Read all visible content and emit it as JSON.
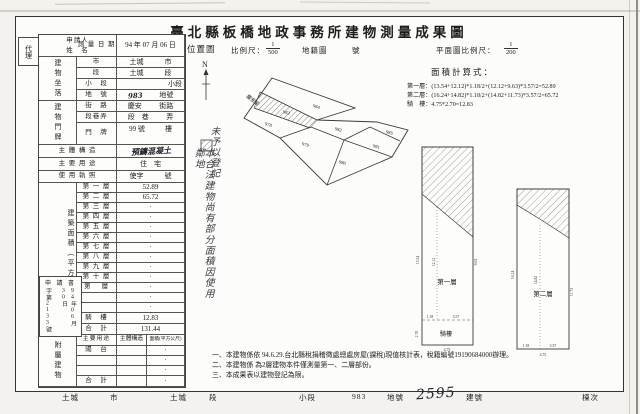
{
  "title": "臺北縣板橋地政事務所建物測量成果圖",
  "agent": "代理",
  "left_table": {
    "applicant_label_1": "申請人",
    "applicant_label_2": "姓　名",
    "survey_date_label": "測 量 日 期",
    "survey_date_value": "94 年 07 月 06 日",
    "site_group_label": "建物坐落",
    "site_rows": [
      {
        "label": "市",
        "value": "土城",
        "suffix": "市"
      },
      {
        "label": "段",
        "value": "土城",
        "suffix": "段"
      },
      {
        "label": "小　段",
        "value": "",
        "suffix": "小段"
      },
      {
        "label": "地　號",
        "value": "983",
        "suffix": "地號"
      }
    ],
    "door_group_label": "建物門牌",
    "street_label": "街　路",
    "street_value": "慶安",
    "street_suffix": "街路",
    "lane_label": "段巷弄",
    "lane_value": "段　巷",
    "lane_suffix": "弄",
    "door_no_label": "門　牌",
    "door_no_value": "99 號",
    "door_no_suffix": "樓",
    "structure_label": "主 體 構 造",
    "structure_value": "預鑄混凝土",
    "usage_label": "主 要 用 途",
    "usage_value": "住　宅",
    "license_label": "使 用 執 照",
    "license_prefix": "使字",
    "license_suffix": "號",
    "area_group_label": "建築面積（平方公尺）",
    "floors": [
      {
        "label": "第 一 層",
        "value": "52.89"
      },
      {
        "label": "第 二 層",
        "value": "65.72"
      },
      {
        "label": "第 三 層",
        "value": "·"
      },
      {
        "label": "第 四 層",
        "value": "·"
      },
      {
        "label": "第 五 層",
        "value": "·"
      },
      {
        "label": "第 六 層",
        "value": "·"
      },
      {
        "label": "第 七 層",
        "value": "·"
      },
      {
        "label": "第 八 層",
        "value": "·"
      },
      {
        "label": "第 九 層",
        "value": "·"
      },
      {
        "label": "第 十 層",
        "value": "·"
      },
      {
        "label": "第　 層",
        "value": "·"
      },
      {
        "label": "",
        "value": "·"
      },
      {
        "label": "",
        "value": "·"
      }
    ],
    "arcade_label": "騎　樓",
    "arcade_value": "12.83",
    "total_label": "合　計",
    "total_value": "131.44",
    "application": {
      "title": "申 請 書",
      "number_column": "字第2133號",
      "date_column": "94年06月30日"
    },
    "annex_group_label": "附屬建物",
    "annex_headers": [
      "主要用途",
      "主體構造",
      "面積(平方公尺)"
    ],
    "annex_rows": [
      {
        "use": "陽　台",
        "structure": "",
        "area": "·"
      },
      {
        "use": "",
        "structure": "",
        "area": "·"
      },
      {
        "use": "",
        "structure": "",
        "area": "·"
      },
      {
        "use": "合　計",
        "structure": "",
        "area": "·"
      }
    ]
  },
  "map_header": {
    "location_map_label": "位置圖",
    "scale_label": "比例尺：",
    "scale_numerator": "1",
    "scale_denominator": "500",
    "cadastral_label": "地籍圖",
    "cadastral_number_label": "號",
    "plan_scale_label": "平面圖比例尺：",
    "plan_scale_numerator": "1",
    "plan_scale_denominator": "200"
  },
  "location_map": {
    "north_label": "N",
    "street_label": "慶安街",
    "parcels": [
      "984",
      "983",
      "978",
      "982",
      "985",
      "979",
      "981",
      "980"
    ],
    "hand_note_col_1": "本合法建物尚有部分面積因使用鄰地",
    "hand_note_col_2": "未予以登記"
  },
  "area_calc": {
    "title": "面積計算式：",
    "lines": [
      "第一層：(13.54+12.12)*1.18/2+(12.12+9.63)*3.57/2=52.89",
      "第二層：(16.24+14.82)*1.18/2+(14.82+11.73)*3.57/2=65.72",
      "騎　樓：4.75*2.70=12.83"
    ]
  },
  "floor_plans": {
    "first": {
      "label": "第一層",
      "arcade_label": "騎樓",
      "dim_left": "13.54",
      "dim_mid": "12.12",
      "dim_right": "9.63",
      "dim_w1": "1.18",
      "dim_w2": "3.57",
      "arcade_width": "4.75",
      "arcade_height": "2.70"
    },
    "second": {
      "label": "第二層",
      "dim_left": "16.24",
      "dim_mid": "14.82",
      "dim_right": "11.73",
      "dim_w1": "1.18",
      "dim_w2": "3.57",
      "dim_total": "4.75"
    }
  },
  "notes": [
    "一、本建物係依 94.6.29.台北縣稅捐稽徵處總處房屋(課稅)現值核計表，稅籍編號19190684000辦理。",
    "二、本建物係 為2層建物本件僅測量第一、二層部份。",
    "三、本成果表以建物登記為限。"
  ],
  "footer": {
    "city_value": "土城",
    "city_label": "市",
    "section_value": "土城",
    "section_label": "段",
    "subsection_label": "小段",
    "parcel_value": "983",
    "parcel_label": "地號",
    "building_value": "2595",
    "building_label": "建號",
    "unit_label": "棟次"
  }
}
